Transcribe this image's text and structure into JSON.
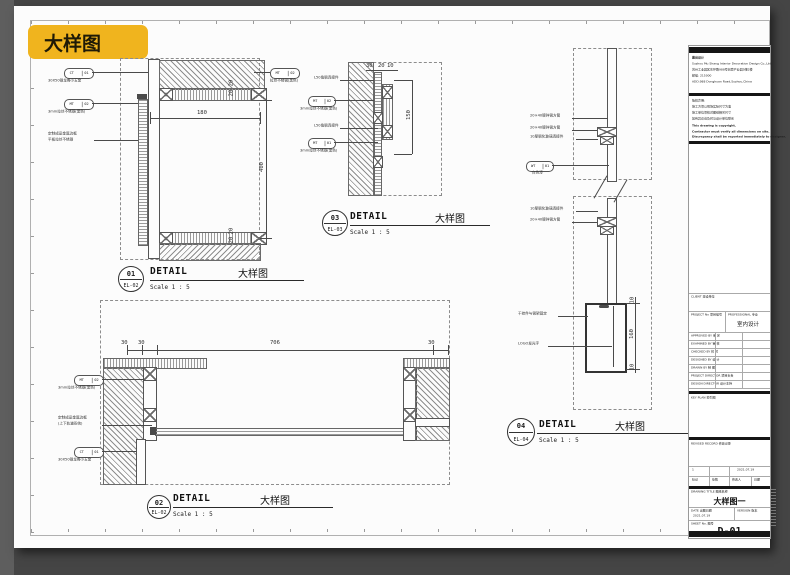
{
  "badge": "大样图",
  "details": {
    "d01": {
      "num": "01",
      "ref": "EL-02",
      "detail_label": "DETAIL",
      "cn": "大样图",
      "scale": "Scale 1 : 5",
      "dim_w": "180",
      "dim_h": "400",
      "dim_t1": "20",
      "dim_t2": "20",
      "dim_b1": "20",
      "dim_b2": "20",
      "c1_code": "CT",
      "c1_no": "01",
      "c1_cap": "30X50钢龙骨小五金",
      "c2_code": "MT",
      "c2_no": "02",
      "c2_cap": "3mm拉丝不锈钢(黑色)",
      "c3_cap1": "定制成品金属边框",
      "c3_cap2": "平板拉丝不锈钢",
      "c4_code": "MT",
      "c4_no": "02",
      "c4_cap": "拉丝不锈钢(黑色)"
    },
    "d03": {
      "num": "03",
      "ref": "EL-03",
      "detail_label": "DETAIL",
      "cn": "大样图",
      "scale": "Scale 1 : 5",
      "dim_1": "30",
      "dim_2": "20",
      "dim_3": "10",
      "dim_h": "150",
      "c1_cap": "L50角钢连接件",
      "c2_code": "MT",
      "c2_no": "02",
      "c2_cap": "3mm拉丝不锈钢(黑色)",
      "c3_cap": "L50角钢连接件",
      "c4_code": "MT",
      "c4_no": "01",
      "c4_cap": "3mm拉丝不锈钢(黑色)"
    },
    "d02": {
      "num": "02",
      "ref": "EL-02",
      "detail_label": "DETAIL",
      "cn": "大样图",
      "scale": "Scale 1 : 5",
      "dim_1": "30",
      "dim_2": "30",
      "dim_3": "706",
      "dim_4": "30",
      "c1_code": "MT",
      "c1_no": "02",
      "c1_cap": "3mm拉丝不锈钢(黑色)",
      "c2_cap1": "定制成品金属边框",
      "c2_cap2": "(上下轨道系统)",
      "c3_code": "CT",
      "c3_no": "01",
      "c3_cap": "30X50钢龙骨小五金"
    },
    "d04": {
      "num": "04",
      "ref": "EL-04",
      "detail_label": "DETAIL",
      "cn": "大样图",
      "scale": "Scale 1 : 5",
      "dim_h": "160",
      "dim_t": "10",
      "dim_b": "10",
      "c1_cap": "20×40镀锌钢方管",
      "c2_cap": "20×40镀锌钢方管",
      "c3_cap": "10厚钢化玻璃连接件",
      "c4_code": "WT",
      "c4_no": "01",
      "c4_cap": "白色漆",
      "c5_cap": "10厚钢化玻璃连接件",
      "c6_cap": "20×40镀锌钢方管",
      "c7_cap": "干挂件与钢架固定",
      "c8_cap": "LOGO发光字"
    }
  },
  "titleblock": {
    "company_1": "慕尚设计",
    "company_2": "Suzhou Mu Shang Interior Decoration Design Co.,Ltd.",
    "company_3": "苏州工业园区东环路988号创意产业园5幢2楼",
    "company_4": "邮编: 215000",
    "company_5": "ADD.988 Donghuan Road,Suzhou,China",
    "notes_cn_1": "版权声明:",
    "notes_cn_2": "施工方须以现场实际尺寸为准",
    "notes_cn_3": "施工单位须核对图纸相关尺寸",
    "notes_cn_4": "如有异议请及时与设计单位联系",
    "notes_en_1": "This drawing is copyright.",
    "notes_en_2": "Contractor must verify all dimensions on site.",
    "notes_en_3": "Discrepancy shall be reported immediately to designer.",
    "client_label": "CLIENT 建设单位",
    "project_no_label": "PROJECT No 项目编号",
    "professional_label": "PROFESSIONAL 专业",
    "professional_value": "室内设计",
    "p1": "APPROVED BY 审 定",
    "p2": "EXAMINED BY 审 核",
    "p3": "CHECKED BY 校 对",
    "p4": "DESIGNED BY 设 计",
    "p5": "DRAWN BY 制 图",
    "p6": "PROJECT DIRECTOR 项目负责",
    "p7": "DESIGN DIRECTOR 设计主持",
    "keyplan_label": "KEY PLAN 索引图",
    "revised_label": "REVISED RECORD 修改记录",
    "rev_no": "1",
    "rev_date": "2021.07.19",
    "rh1": "标记",
    "rh2": "处数",
    "rh3": "修改人",
    "rh4": "日期",
    "drawing_title_label": "DRAWING TITLE 图纸名称",
    "drawing_title": "大样图一",
    "date_label": "DATE 出图日期",
    "date_value": "2021.07.19",
    "version_label": "VERSION 版本",
    "sheet_label": "SHEET No. 图号",
    "sheet_no": "D-01"
  },
  "colors": {
    "badge_bg": "#f0b41e",
    "canvas_bg": "#454545",
    "page_bg": "#fcfcfc"
  }
}
